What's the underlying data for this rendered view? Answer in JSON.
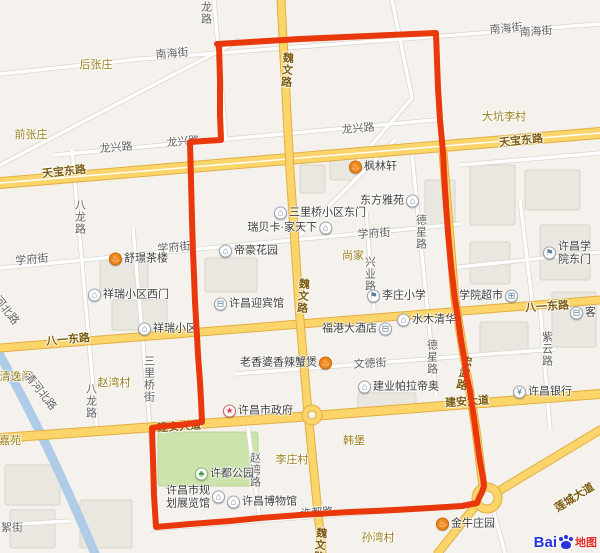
{
  "boundary": {
    "color": "#e8380c",
    "width": 6,
    "points": "217,44 300,39 436,33 438,88 440,120 443,152 445,190 448,232 451,265 455,300 458,318 461,340 464,357 467,378 470,391 472,405 475,425 477,440 479,455 481,467 483,478 484,486 482,492 479,498 477,503 462,506 430,508 395,510 350,512 300,515 260,518 230,521 190,524 156,527 154,495 153,460 152,428 165,426 180,425 202,422 201,400 200,382 198,355 197,336 195,302 194,275 193,252 192,220 191,180 190,142 204,141 221,140 220,115 220,80 219,44"
  },
  "icons": {
    "food": {
      "g": "♨",
      "bg": "#f08519",
      "bd": "#c96a06",
      "fg": "#ffffff"
    },
    "bldg": {
      "g": "⌂",
      "bg": "#ffffff",
      "bd": "#9aa3b0",
      "fg": "#5b7fa6"
    },
    "hotel": {
      "g": "⊟",
      "bg": "#ffffff",
      "bd": "#9aa3b0",
      "fg": "#5b7fa6"
    },
    "bank": {
      "g": "¥",
      "bg": "#ffffff",
      "bd": "#9aa3b0",
      "fg": "#5b7fa6"
    },
    "gov": {
      "g": "★",
      "bg": "#ffffff",
      "bd": "#c86a6a",
      "fg": "#e04040"
    },
    "park": {
      "g": "♣",
      "bg": "#ffffff",
      "bd": "#8fb489",
      "fg": "#3f9e3f"
    },
    "school": {
      "g": "⚑",
      "bg": "#ffffff",
      "bd": "#9aa3b0",
      "fg": "#5b7fa6"
    },
    "market": {
      "g": "⊞",
      "bg": "#ffffff",
      "bd": "#9aa3b0",
      "fg": "#5b7fa6"
    },
    "museum": {
      "g": "⌂",
      "bg": "#ffffff",
      "bd": "#9aa3b0",
      "fg": "#7a6a9e"
    }
  },
  "labels": [
    {
      "id": "village-houzhangzhuang",
      "t": "后张庄",
      "x": 96,
      "y": 64,
      "k": "vg"
    },
    {
      "id": "village-qianzhangzhuang",
      "t": "前张庄",
      "x": 31,
      "y": 134,
      "k": "vg"
    },
    {
      "id": "village-dakenglicun",
      "t": "大坑李村",
      "x": 504,
      "y": 116,
      "k": "vg"
    },
    {
      "id": "village-shangjia",
      "t": "尚家",
      "x": 353,
      "y": 255,
      "k": "vg"
    },
    {
      "id": "village-zhaowancun",
      "t": "赵湾村",
      "x": 114,
      "y": 382,
      "k": "vg"
    },
    {
      "id": "village-qingyige",
      "t": "清逸阁",
      "x": 16,
      "y": 376,
      "k": "vg"
    },
    {
      "id": "village-jiayuan",
      "t": "嘉苑",
      "x": 10,
      "y": 440,
      "k": "vg"
    },
    {
      "id": "village-lizhuangcun",
      "t": "李庄村",
      "x": 292,
      "y": 459,
      "k": "vg"
    },
    {
      "id": "village-hanbao",
      "t": "韩堡",
      "x": 354,
      "y": 440,
      "k": "vg"
    },
    {
      "id": "village-sunwancun",
      "t": "孙湾村",
      "x": 378,
      "y": 537,
      "k": "vg"
    },
    {
      "id": "road-tianbaodonglu-w",
      "t": "天宝东路",
      "x": 64,
      "y": 171,
      "k": "yr",
      "r": -6
    },
    {
      "id": "road-tianbaodonglu-e",
      "t": "天宝东路",
      "x": 521,
      "y": 140,
      "k": "yr",
      "r": -6
    },
    {
      "id": "road-bayidonglu-w",
      "t": "八一东路",
      "x": 68,
      "y": 339,
      "k": "yr",
      "r": -5
    },
    {
      "id": "road-bayidonglu-e",
      "t": "八一东路",
      "x": 547,
      "y": 306,
      "k": "yr",
      "r": -4
    },
    {
      "id": "road-jiananddadao-e",
      "t": "建安大道",
      "x": 467,
      "y": 401,
      "k": "yr",
      "r": -4
    },
    {
      "id": "road-jiananddadao-w",
      "t": "建安大道",
      "x": 179,
      "y": 426,
      "k": "yr",
      "r": -4
    },
    {
      "id": "road-lianchengdadao",
      "t": "莲城大道",
      "x": 574,
      "y": 497,
      "k": "yr",
      "r": -32
    },
    {
      "id": "road-weiwenlu-n",
      "t": "魏文路",
      "x": 286,
      "y": 70,
      "k": "yr",
      "v": 1,
      "r": 4
    },
    {
      "id": "road-weiwenlu-m",
      "t": "魏文路",
      "x": 302,
      "y": 296,
      "k": "yr",
      "v": 1,
      "r": 4
    },
    {
      "id": "road-weiwenlu-s",
      "t": "魏文路",
      "x": 319,
      "y": 545,
      "k": "yr",
      "v": 1,
      "r": 6
    },
    {
      "id": "road-zhongwulu",
      "t": "忠武路",
      "x": 463,
      "y": 373,
      "k": "yr",
      "v": 1,
      "r": 12
    },
    {
      "id": "street-nanhaijie-w",
      "t": "南海街",
      "x": 172,
      "y": 53,
      "k": "st",
      "r": -5
    },
    {
      "id": "street-nanhaijie-e1",
      "t": "南海街",
      "x": 506,
      "y": 28,
      "k": "st",
      "r": -5
    },
    {
      "id": "street-nanhaijie-e2",
      "t": "南海街",
      "x": 536,
      "y": 31,
      "k": "st",
      "r": -4
    },
    {
      "id": "street-longxinglu-w",
      "t": "龙兴路",
      "x": 116,
      "y": 147,
      "k": "st",
      "r": -5
    },
    {
      "id": "street-longxinglu-m",
      "t": "龙兴路",
      "x": 183,
      "y": 141,
      "k": "st",
      "r": -5
    },
    {
      "id": "street-longxinglu-e",
      "t": "龙兴路",
      "x": 358,
      "y": 128,
      "k": "st",
      "r": -5
    },
    {
      "id": "street-xuefujie-w",
      "t": "学府街",
      "x": 32,
      "y": 259,
      "k": "st",
      "r": -5
    },
    {
      "id": "street-xuefujie-m",
      "t": "学府街",
      "x": 174,
      "y": 247,
      "k": "st",
      "r": -5
    },
    {
      "id": "street-xuefujie-e",
      "t": "学府街",
      "x": 374,
      "y": 233,
      "k": "st",
      "r": -4
    },
    {
      "id": "street-wendejie",
      "t": "文德街",
      "x": 370,
      "y": 363,
      "k": "st",
      "r": -3
    },
    {
      "id": "street-xudulu",
      "t": "许都路",
      "x": 317,
      "y": 512,
      "k": "st",
      "r": -4
    },
    {
      "id": "street-qinghebeilu",
      "t": "清河北路",
      "x": 41,
      "y": 391,
      "k": "st",
      "r": 52
    },
    {
      "id": "street-hebeilu",
      "t": "河北路",
      "x": 7,
      "y": 310,
      "k": "st",
      "r": 52
    },
    {
      "id": "street-xujie",
      "t": "絮街",
      "x": 12,
      "y": 527,
      "k": "st"
    },
    {
      "id": "street-longlu",
      "t": "龙路",
      "x": 205,
      "y": 13,
      "k": "st",
      "v": 1
    },
    {
      "id": "street-balonglu-n",
      "t": "八龙路",
      "x": 79,
      "y": 217,
      "k": "st",
      "v": 1
    },
    {
      "id": "street-balonglu-s",
      "t": "八龙路",
      "x": 90,
      "y": 401,
      "k": "st",
      "v": 1
    },
    {
      "id": "street-sanliqiaojie",
      "t": "三里桥街",
      "x": 148,
      "y": 379,
      "k": "st",
      "v": 1
    },
    {
      "id": "street-dexinglu-n",
      "t": "德星路",
      "x": 420,
      "y": 232,
      "k": "st",
      "v": 1
    },
    {
      "id": "street-dexinglu-s",
      "t": "德星路",
      "x": 431,
      "y": 357,
      "k": "st",
      "v": 1
    },
    {
      "id": "street-xingyelu",
      "t": "兴业路",
      "x": 369,
      "y": 274,
      "k": "st",
      "v": 1
    },
    {
      "id": "street-ziyunlu",
      "t": "紫云路",
      "x": 546,
      "y": 349,
      "k": "st",
      "v": 1
    },
    {
      "id": "street-zhaowanlu",
      "t": "赵湾路",
      "x": 254,
      "y": 470,
      "k": "st",
      "v": 1
    }
  ],
  "pois": [
    {
      "id": "poi-shujing-teahouse",
      "t": "舒璟茶楼",
      "x": 117,
      "y": 259,
      "icon": "food",
      "side": "right"
    },
    {
      "id": "poi-fenglinxuan",
      "t": "枫林轩",
      "x": 357,
      "y": 167,
      "icon": "food",
      "side": "right"
    },
    {
      "id": "poi-dihao-garden",
      "t": "帝豪花园",
      "x": 227,
      "y": 251,
      "icon": "bldg",
      "side": "right"
    },
    {
      "id": "poi-dongfangyayuan",
      "t": "东方雅苑",
      "x": 411,
      "y": 201,
      "icon": "bldg",
      "side": "left"
    },
    {
      "id": "poi-sanliqiao-east-gate",
      "t": "三里桥小区东门",
      "x": 282,
      "y": 213,
      "icon": "bldg",
      "side": "right"
    },
    {
      "id": "poi-ruibeika-jiatianxia",
      "t": "瑞贝卡·家天下",
      "x": 324,
      "y": 228,
      "icon": "bldg",
      "side": "left"
    },
    {
      "id": "poi-xiangrui-west-gate",
      "t": "祥瑞小区西门",
      "x": 96,
      "y": 295,
      "icon": "bldg",
      "side": "right"
    },
    {
      "id": "poi-xiangrui-xiaoqu",
      "t": "祥瑞小区",
      "x": 146,
      "y": 329,
      "icon": "bldg",
      "side": "right"
    },
    {
      "id": "poi-xuchang-yingbinguan",
      "t": "许昌迎宾馆",
      "x": 222,
      "y": 304,
      "icon": "hotel",
      "side": "right"
    },
    {
      "id": "poi-fugang-hotel",
      "t": "福港大酒店",
      "x": 384,
      "y": 329,
      "icon": "hotel",
      "side": "left"
    },
    {
      "id": "poi-shuimuqinghua",
      "t": "水木清华",
      "x": 405,
      "y": 320,
      "icon": "bldg",
      "side": "right"
    },
    {
      "id": "poi-lizhuang-primary-school",
      "t": "李庄小学",
      "x": 375,
      "y": 296,
      "icon": "school",
      "side": "right"
    },
    {
      "id": "poi-xueyuan-supermarket",
      "t": "学院超市",
      "x": 510,
      "y": 296,
      "icon": "market",
      "side": "left"
    },
    {
      "id": "poi-xuchang-college-east-gate",
      "t": "许昌学院东门",
      "x": 551,
      "y": 253,
      "icon": "school",
      "side": "right"
    },
    {
      "id": "poi-ke-hotel",
      "t": "客",
      "x": 578,
      "y": 313,
      "icon": "hotel",
      "side": "right"
    },
    {
      "id": "poi-xuchang-bank",
      "t": "许昌银行",
      "x": 521,
      "y": 392,
      "icon": "bank",
      "side": "right"
    },
    {
      "id": "poi-laoxiangpo-crab-pot",
      "t": "老香婆香辣蟹煲",
      "x": 324,
      "y": 363,
      "icon": "food",
      "side": "left"
    },
    {
      "id": "poi-jianye-palladio",
      "t": "建业帕拉帝奥",
      "x": 366,
      "y": 387,
      "icon": "bldg",
      "side": "right"
    },
    {
      "id": "poi-xuchang-city-government",
      "t": "许昌市政府",
      "x": 231,
      "y": 411,
      "icon": "gov",
      "side": "right"
    },
    {
      "id": "poi-xudu-park",
      "t": "许都公园",
      "x": 203,
      "y": 474,
      "icon": "park",
      "side": "right"
    },
    {
      "id": "poi-xuchang-planning-hall",
      "t": "许昌市规\n划展览馆",
      "x": 217,
      "y": 497,
      "icon": "museum",
      "side": "left"
    },
    {
      "id": "poi-xuchang-museum",
      "t": "许昌博物馆",
      "x": 235,
      "y": 502,
      "icon": "museum",
      "side": "right"
    },
    {
      "id": "poi-jinniu-zhuangyuan",
      "t": "金牛庄园",
      "x": 444,
      "y": 524,
      "icon": "food",
      "side": "right"
    }
  ],
  "logo": {
    "bai": "Bai",
    "map": "地图"
  }
}
